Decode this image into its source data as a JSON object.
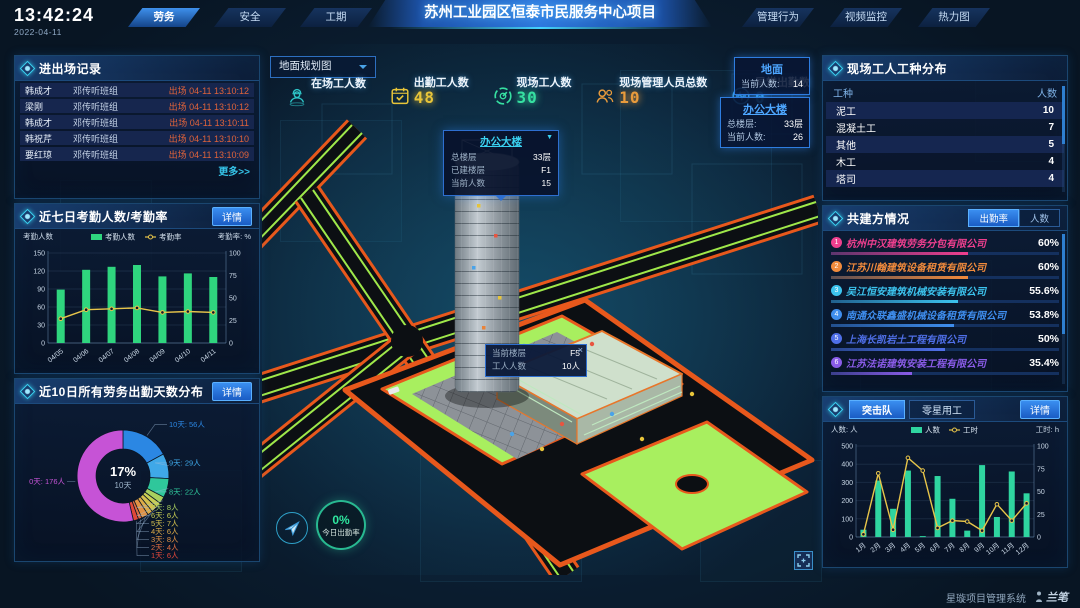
{
  "header": {
    "time": "13:42:24",
    "date": "2022-04-11",
    "left_tabs": [
      {
        "label": "劳务",
        "active": true
      },
      {
        "label": "安全",
        "active": false
      },
      {
        "label": "工期",
        "active": false
      }
    ],
    "title": "苏州工业园区恒泰市民服务中心项目",
    "right_tabs": [
      "管理行为",
      "视频监控",
      "热力图"
    ]
  },
  "left": {
    "records": {
      "title": "进出场记录",
      "rows": [
        {
          "name": "韩成才",
          "team": "邓传听班组",
          "event": "出场 04-11 13:10:12"
        },
        {
          "name": "梁刚",
          "team": "邓传听班组",
          "event": "出场 04-11 13:10:12"
        },
        {
          "name": "韩成才",
          "team": "邓传听班组",
          "event": "出场 04-11 13:10:11"
        },
        {
          "name": "韩祝芹",
          "team": "邓传听班组",
          "event": "出场 04-11 13:10:10"
        },
        {
          "name": "要红琼",
          "team": "邓传听班组",
          "event": "出场 04-11 13:10:09"
        }
      ],
      "more": "更多>>"
    },
    "attendance_title": "近七日考勤人数/考勤率",
    "attendance_detail": "详情",
    "distribution_title": "近10日所有劳务出勤天数分布",
    "distribution_detail": "详情"
  },
  "center": {
    "map_select": "地面规划图",
    "stats": [
      {
        "icon": "worker-icon",
        "label": "在场工人数",
        "value": "",
        "color": "#2ec7c9"
      },
      {
        "icon": "calendar-check-icon",
        "label": "出勤工人数",
        "value": "48",
        "color": "#e8c539"
      },
      {
        "icon": "gauge-icon",
        "label": "现场工人数",
        "value": "30",
        "color": "#36e0a1"
      },
      {
        "icon": "people-icon",
        "label": "现场管理人员总数",
        "value": "10",
        "color": "#e89b3c"
      },
      {
        "icon": "pulse-icon",
        "label": "异常出勤数",
        "value": "0",
        "color": "#38a6e8"
      }
    ],
    "floor_cards": [
      {
        "title": "地面",
        "rows": [
          {
            "label": "当前人数:",
            "value": "14"
          }
        ]
      },
      {
        "title": "办公大楼",
        "rows": [
          {
            "label": "总楼层:",
            "value": "33层"
          },
          {
            "label": "当前人数:",
            "value": "26"
          }
        ]
      }
    ],
    "building_tooltip": {
      "title": "办公大楼",
      "caret": "▼",
      "rows": [
        {
          "label": "总楼层",
          "value": "33层"
        },
        {
          "label": "已建楼层",
          "value": "F1"
        },
        {
          "label": "当前人数",
          "value": "15"
        }
      ]
    },
    "floor_tooltip": {
      "close": "×",
      "rows": [
        {
          "label": "当前楼层",
          "value": "F5"
        },
        {
          "label": "工人人数",
          "value": "10人"
        }
      ]
    },
    "badge": {
      "value": "0%",
      "label": "今日出勤率"
    }
  },
  "right": {
    "worktype": {
      "title": "现场工人工种分布",
      "headers": [
        "工种",
        "人数"
      ],
      "rows": [
        [
          "泥工",
          "10"
        ],
        [
          "混凝土工",
          "7"
        ],
        [
          "其他",
          "5"
        ],
        [
          "木工",
          "4"
        ],
        [
          "塔司",
          "4"
        ]
      ]
    },
    "partners": {
      "title": "共建方情况",
      "tabs": [
        {
          "label": "出勤率",
          "active": true
        },
        {
          "label": "人数",
          "active": false
        }
      ],
      "items": [
        {
          "rank": "1",
          "name": "杭州中汉建筑劳务分包有限公司",
          "value": "60%",
          "pct": 60,
          "color": "#ee3f8e"
        },
        {
          "rank": "2",
          "name": "江苏川翰建筑设备租赁有限公司",
          "value": "60%",
          "pct": 60,
          "color": "#f08a3c"
        },
        {
          "rank": "3",
          "name": "吴江恒安建筑机械安装有限公司",
          "value": "55.6%",
          "pct": 55.6,
          "color": "#3cc3ee"
        },
        {
          "rank": "4",
          "name": "南通众联鑫盛机械设备租赁有限公司",
          "value": "53.8%",
          "pct": 53.8,
          "color": "#3f8eee"
        },
        {
          "rank": "5",
          "name": "上海长凯岩土工程有限公司",
          "value": "50%",
          "pct": 50,
          "color": "#4f6fe8"
        },
        {
          "rank": "6",
          "name": "江苏法诺建筑安装工程有限公司",
          "value": "35.4%",
          "pct": 35.4,
          "color": "#8a5ce8"
        }
      ]
    },
    "teams": {
      "tabs": [
        {
          "label": "突击队",
          "active": true
        },
        {
          "label": "零星用工",
          "active": false
        }
      ],
      "detail": "详情"
    }
  },
  "footer": {
    "brand": "星璇项目管理系统",
    "logo": "兰笔"
  },
  "chart_data": [
    {
      "id": "attendance",
      "type": "bar+line",
      "categories": [
        "04/05",
        "04/06",
        "04/07",
        "04/08",
        "04/09",
        "04/10",
        "04/11"
      ],
      "series": [
        {
          "name": "考勤人数",
          "type": "bar",
          "axis": "left",
          "color": "#2fd57e",
          "values": [
            89,
            122,
            127,
            130,
            111,
            116,
            110
          ]
        },
        {
          "name": "考勤率",
          "type": "line",
          "axis": "right",
          "color": "#e7c54a",
          "values": [
            27,
            37,
            38,
            39,
            34,
            35,
            34
          ]
        }
      ],
      "left_axis": {
        "label": "考勤人数",
        "min": 0,
        "max": 150,
        "ticks": [
          0,
          30,
          60,
          90,
          120,
          150
        ]
      },
      "right_axis": {
        "label": "考勤率: %",
        "min": 0,
        "max": 100,
        "ticks": [
          0,
          25,
          50,
          75,
          100
        ]
      },
      "legend_position": "top",
      "grid": true
    },
    {
      "id": "distribution",
      "type": "donut",
      "title": "近10日所有劳务出勤天数分布",
      "center": {
        "value": "17%",
        "label": "10天"
      },
      "slices": [
        {
          "label": "10天",
          "count": 56,
          "unit": "人",
          "color": "#2b87e3"
        },
        {
          "label": "9天",
          "count": 29,
          "unit": "人",
          "color": "#3fa8e8"
        },
        {
          "label": "8天",
          "count": 22,
          "unit": "人",
          "color": "#2fc79b"
        },
        {
          "label": "7天",
          "count": 8,
          "unit": "人",
          "color": "#a8cf5e"
        },
        {
          "label": "6天",
          "count": 6,
          "unit": "人",
          "color": "#c9cf54"
        },
        {
          "label": "5天",
          "count": 7,
          "unit": "人",
          "color": "#d4c04e"
        },
        {
          "label": "4天",
          "count": 6,
          "unit": "人",
          "color": "#ddab48"
        },
        {
          "label": "3天",
          "count": 8,
          "unit": "人",
          "color": "#e09245"
        },
        {
          "label": "2天",
          "count": 4,
          "unit": "人",
          "color": "#e06d40"
        },
        {
          "label": "1天",
          "count": 6,
          "unit": "人",
          "color": "#e0483a"
        },
        {
          "label": "0天",
          "count": 176,
          "unit": "人",
          "color": "#c653d6"
        }
      ]
    },
    {
      "id": "teams",
      "type": "bar+line",
      "categories": [
        "1月",
        "2月",
        "3月",
        "4月",
        "5月",
        "6月",
        "7月",
        "8月",
        "9月",
        "10月",
        "11月",
        "12月"
      ],
      "series": [
        {
          "name": "人数",
          "type": "bar",
          "axis": "left",
          "color": "#2fd5a0",
          "values": [
            40,
            310,
            155,
            365,
            5,
            335,
            210,
            35,
            395,
            110,
            360,
            240
          ]
        },
        {
          "name": "工时",
          "type": "line",
          "axis": "right",
          "color": "#e7c54a",
          "values": [
            3,
            70,
            8,
            87,
            73,
            10,
            18,
            17,
            7,
            36,
            18,
            37
          ]
        }
      ],
      "left_axis": {
        "label": "人数: 人",
        "min": 0,
        "max": 500,
        "ticks": [
          0,
          100,
          200,
          300,
          400,
          500
        ]
      },
      "right_axis": {
        "label": "工时: h",
        "min": 0,
        "max": 100,
        "ticks": [
          0,
          25,
          50,
          75,
          100
        ]
      },
      "legend_position": "top",
      "grid": true
    }
  ]
}
